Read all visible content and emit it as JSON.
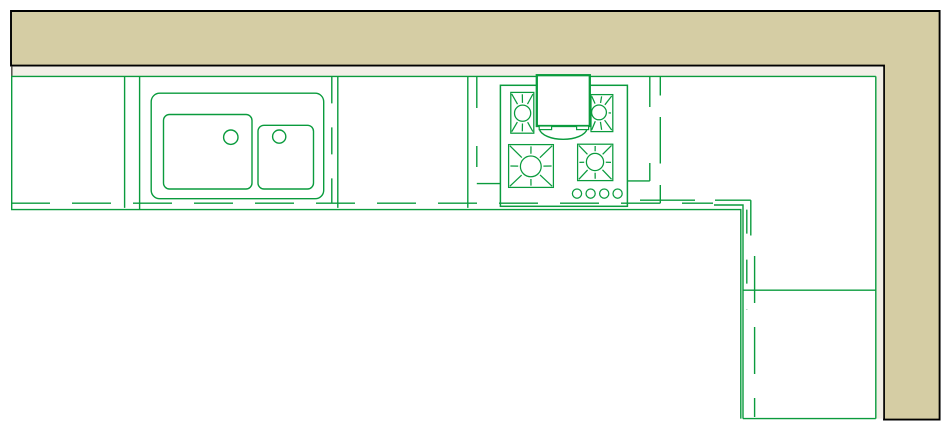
{
  "drawing": {
    "kind": "kitchen-floor-plan-cad",
    "canvas": {
      "width": 952,
      "height": 437,
      "background": "#ffffff"
    },
    "colors": {
      "line_green": "#0a9b3d",
      "wall_fill_tan": "#d5cda4",
      "wall_face_cream": "#f2efe6",
      "wall_outline_black": "#000000",
      "wall_end_cap_grey": "#51504a",
      "fixture_fill_white": "#ffffff"
    },
    "stroke": {
      "default": 1.4,
      "wall_outline": 1.9,
      "hood_box": 2.3,
      "cooktop_body": 1.5,
      "burner": 1.25,
      "end_cap": 1.5
    },
    "wall": {
      "outer_path": "M11 11 H939.6 V419.6 H884 V65.6 H11 Z",
      "face_path": "M11 66.6 H883.2 V418.6 H876 V77 H11 Z",
      "end_cap": {
        "x1": 11.8,
        "y1": 66.6,
        "x2": 11.8,
        "y2": 77
      }
    },
    "solid_lines": [
      {
        "d": "M11 76.4 H875.8"
      },
      {
        "d": "M875.8 76.4 V418.6"
      },
      {
        "d": "M742.9 418.6 H875.8"
      },
      {
        "d": "M11.7 76.4 V209.6"
      },
      {
        "d": "M11 209.6 H740.8 V418.6"
      },
      {
        "d": "M714 205 H743 V418.6"
      },
      {
        "d": "M750.8 200.2 V235.5"
      },
      {
        "d": "M124.6 76.4 V207.9"
      },
      {
        "d": "M139.6 76.4 V209.6"
      },
      {
        "d": "M337.8 76.4 V207.9"
      },
      {
        "d": "M467.8 76.4 V207.9"
      },
      {
        "d": "M476.8 76.4 V108"
      },
      {
        "d": "M476.8 183.6 H500.4"
      },
      {
        "d": "M649.8 76.4 V107"
      },
      {
        "d": "M649.8 163 V180.9"
      },
      {
        "d": "M627.4 180.9 H649.8"
      },
      {
        "d": "M660.3 76.4 V95.5"
      },
      {
        "d": "M660.3 117 V163.5"
      },
      {
        "d": "M660.3 185 V203.4"
      },
      {
        "d": "M742.9 290.2 H875.8"
      }
    ],
    "dashed_lines": [
      {
        "d": "M11 203.2 H713",
        "dash": "39 22"
      },
      {
        "d": "M640 200.2 H750.8",
        "dash": "55 20"
      },
      {
        "d": "M331.8 76.4 V202.5",
        "dash": "27 24"
      },
      {
        "d": "M476.8 146 V183.6",
        "dash": "21 17"
      },
      {
        "d": "M746.8 209.6 V310",
        "dash": "24 26"
      },
      {
        "d": "M754.6 256 V417",
        "dash": "47 24"
      }
    ],
    "sink": {
      "counter": {
        "x": 151.2,
        "y": 93.2,
        "w": 172.5,
        "h": 105.5,
        "rx": 8.5
      },
      "basins": [
        {
          "x": 163.5,
          "y": 114.5,
          "w": 88.5,
          "h": 74.5,
          "rx": 6
        },
        {
          "x": 258.0,
          "y": 125.3,
          "w": 55.5,
          "h": 63.7,
          "rx": 6
        }
      ],
      "drains": [
        {
          "cx": 230.8,
          "cy": 137.2,
          "r": 7.2
        },
        {
          "cx": 279.2,
          "cy": 136.6,
          "r": 6.6
        }
      ]
    },
    "cooktop": {
      "body": {
        "x": 500.4,
        "y": 85.3,
        "w": 127,
        "h": 121
      },
      "burners": [
        {
          "square": {
            "x": 510.8,
            "y": 92.4,
            "w": 23.0,
            "h": 40.8
          },
          "ring": {
            "cx": 522.6,
            "cy": 113.2,
            "r": 8.1
          }
        },
        {
          "square": {
            "x": 591.0,
            "y": 94.6,
            "w": 21.8,
            "h": 37.0
          },
          "ring": {
            "cx": 599.0,
            "cy": 112.4,
            "r": 7.4
          }
        },
        {
          "square": {
            "x": 508.6,
            "y": 144.6,
            "w": 44.8,
            "h": 42.8
          },
          "ring": {
            "cx": 530.8,
            "cy": 166.4,
            "r": 10.4
          }
        },
        {
          "square": {
            "x": 577.6,
            "y": 144.2,
            "w": 35.2,
            "h": 36.4
          },
          "ring": {
            "cx": 595.0,
            "cy": 162.0,
            "r": 8.6
          }
        }
      ],
      "knobs": [
        {
          "cx": 577.0,
          "cy": 193.6,
          "r": 4.6
        },
        {
          "cx": 590.6,
          "cy": 193.6,
          "r": 4.6
        },
        {
          "cx": 604.2,
          "cy": 193.6,
          "r": 4.6
        },
        {
          "cx": 617.6,
          "cy": 193.6,
          "r": 4.6
        }
      ]
    },
    "hood": {
      "box": {
        "x": 536.8,
        "y": 75.2,
        "w": 53,
        "h": 50.8
      },
      "feet": [
        {
          "x": 539.2,
          "y": 126,
          "w": 12.4,
          "h": 3.6
        },
        {
          "x": 576.6,
          "y": 126,
          "w": 12.0,
          "h": 3.6
        }
      ],
      "arc": {
        "d": "M539.4 129.2 A24 11.6 0 0 0 587 129.2"
      }
    }
  }
}
